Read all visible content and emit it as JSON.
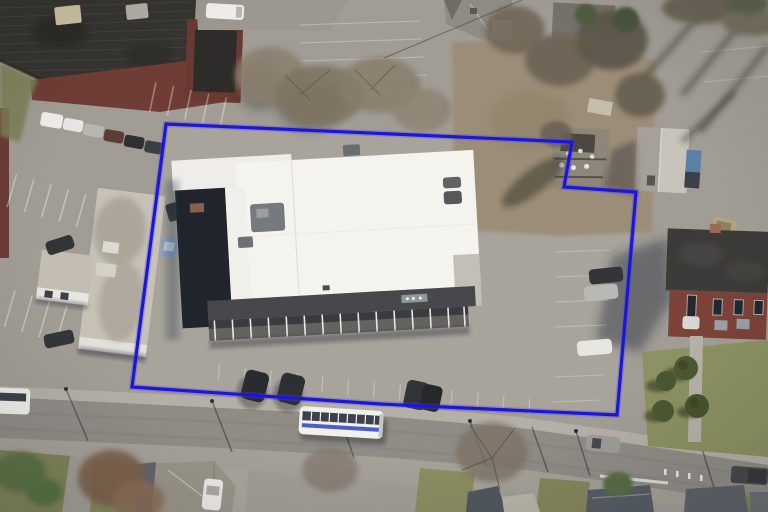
{
  "meta": {
    "title": "Oblique aerial photograph of a commercial parcel with boundary overlay",
    "view": "birds-eye-oblique",
    "width": 768,
    "height": 512
  },
  "parcel": {
    "points": "166,124 572,142 564,187 636,192 617,415 380,404 132,387",
    "outline_color": "#1a13d6",
    "outline_glow": "#4b43e6",
    "shape_note": "irregular parcel with rectangular notch cut out of the north-east corner"
  },
  "scene": {
    "ground": {
      "asphalt": "#a19d95",
      "asphalt_inside_parcel": "#a8a49c",
      "road": "#8f8c86",
      "sidewalk": "#b4b0a7",
      "shoulder": "#a5a198",
      "dirt_scrub": "#9c8d77",
      "lawn": "#8b9161",
      "grass_dark": "#7e8257"
    },
    "landmarks": [
      {
        "id": "main-retail-building",
        "label": "large white flat-roof commercial building with dark storefront fascia and colonnade",
        "roof_color": "#f6f5f0",
        "fascia_color": "#45464a"
      },
      {
        "id": "left-office-building",
        "label": "weathered tan flat-roof building west of parcel",
        "roof_color": "#c8c2b6"
      },
      {
        "id": "factory-roof",
        "label": "black industrial roof with maroon trim, north-west corner",
        "roof_color": "#34322e",
        "trim_color": "#6f3b34"
      },
      {
        "id": "brick-building",
        "label": "two-story red brick building with dark roof, east side",
        "wall_color": "#7b4137",
        "roof_color": "#3b3936"
      },
      {
        "id": "shed",
        "label": "small gray hip-roof outbuilding in north-east notch",
        "roof_color": "#b4b0a7"
      },
      {
        "id": "substation-debris",
        "label": "utility/debris cluster on scrub ground north of parcel"
      },
      {
        "id": "street",
        "label": "two-lane street running along the south edge"
      },
      {
        "id": "houses-south",
        "label": "residential gable/hip roofs along bottom edge"
      },
      {
        "id": "houses-north",
        "label": "residential roofs along top edge"
      }
    ],
    "vehicles": [
      {
        "id": "transit-bus",
        "label": "white transit bus with blue stripe on street",
        "color": "#f2f2ee",
        "stripe": "#4a5cc6"
      },
      {
        "id": "bus-left-edge",
        "label": "white bus partially visible at west street edge",
        "color": "#eeeeea"
      },
      {
        "id": "gray-car-road",
        "label": "gray car travelling on street",
        "color": "#9d9c98"
      },
      {
        "id": "dark-pickup-road",
        "label": "dark pickup at south-east street edge",
        "color": "#44464a"
      },
      {
        "id": "white-car-road",
        "label": "white car near east kerb",
        "color": "#dddcd6"
      },
      {
        "id": "lot-suv-1",
        "label": "dark SUV parked in south lot",
        "color": "#26282c"
      },
      {
        "id": "lot-suv-2",
        "label": "dark SUV parked in south lot",
        "color": "#2b2d31"
      },
      {
        "id": "lot-suv-3",
        "label": "dark cars parked mid south lot",
        "color": "#2f3135"
      },
      {
        "id": "east-lot-dark-car",
        "label": "dark car parked near east boundary",
        "color": "#303236"
      },
      {
        "id": "east-lot-silver-car",
        "label": "silver car parked near east boundary",
        "color": "#b9b8b4"
      },
      {
        "id": "east-lot-white-car",
        "label": "white car parked near east boundary",
        "color": "#e8e7e2"
      },
      {
        "id": "west-car-row",
        "label": "row of six cars parked by factory",
        "colors": [
          "#f0efeb",
          "#e8e7e3",
          "#b9b7b2",
          "#5d3a38",
          "#2e2e31",
          "#3a3c40"
        ]
      },
      {
        "id": "tan-car",
        "label": "tan car parked near north-east lot",
        "color": "#b3a37f"
      },
      {
        "id": "driveway-white-car",
        "label": "white car in south-west driveway",
        "color": "#ecebe7"
      },
      {
        "id": "white-van-top",
        "label": "white van on alley at top edge",
        "color": "#f1f0ec"
      },
      {
        "id": "blue-dumpster",
        "label": "blue dumpster beside shed",
        "color": "#5b7fa6"
      }
    ],
    "vegetation": {
      "bare_tree": "#7d7261",
      "green_tree": "#5a7045",
      "shrub": "#4b5631"
    }
  }
}
